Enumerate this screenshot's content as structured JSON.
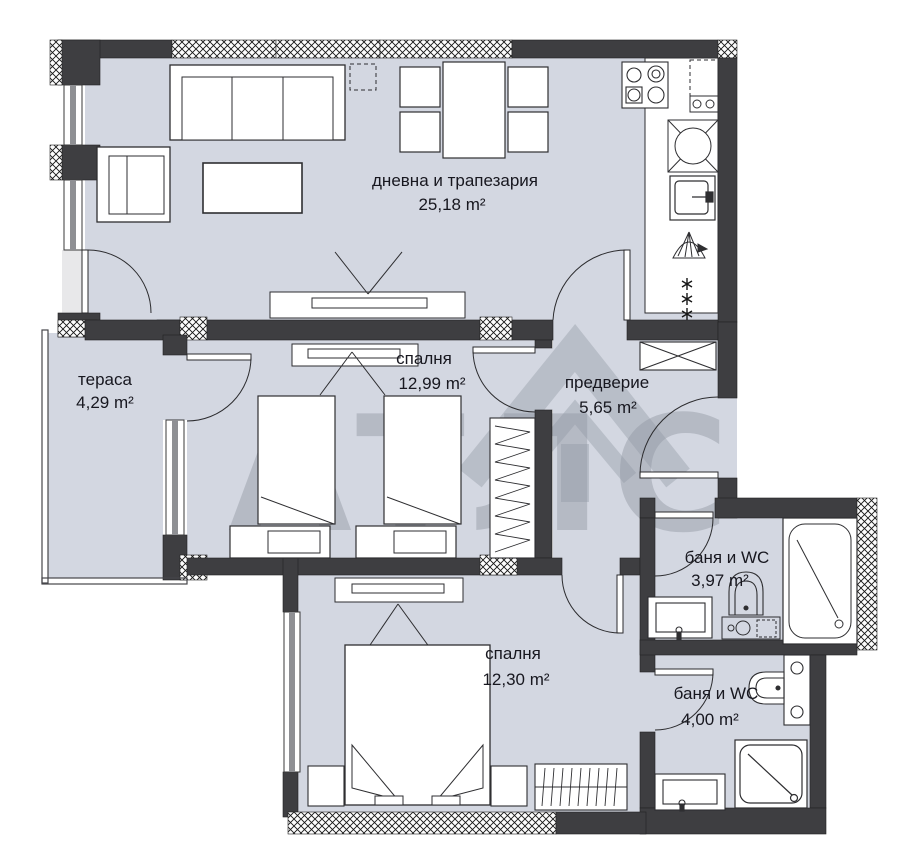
{
  "plan": {
    "title": "apartment-floor-plan",
    "watermark": {
      "full": "АТЛАС",
      "left": "АТЛ",
      "right": "С"
    },
    "rooms": {
      "living": {
        "label": "дневна и трапезария",
        "area": "25,18 m²"
      },
      "terrace": {
        "label": "тераса",
        "area": "4,29 m²"
      },
      "bedroom1": {
        "label": "спалня",
        "area": "12,99 m²"
      },
      "hallway": {
        "label": "предверие",
        "area": "5,65 m²"
      },
      "bath1": {
        "label": "баня и WC",
        "area": "3,97 m²"
      },
      "bedroom2": {
        "label": "спалня",
        "area": "12,30 m²"
      },
      "bath2": {
        "label": "баня и WC",
        "area": "4,00 m²"
      }
    },
    "colors": {
      "floor": "#d3d7e1",
      "wall": "#3e3e41",
      "line": "#2b2b2e",
      "label": "#17171f",
      "watermark": "#9298a3"
    }
  }
}
